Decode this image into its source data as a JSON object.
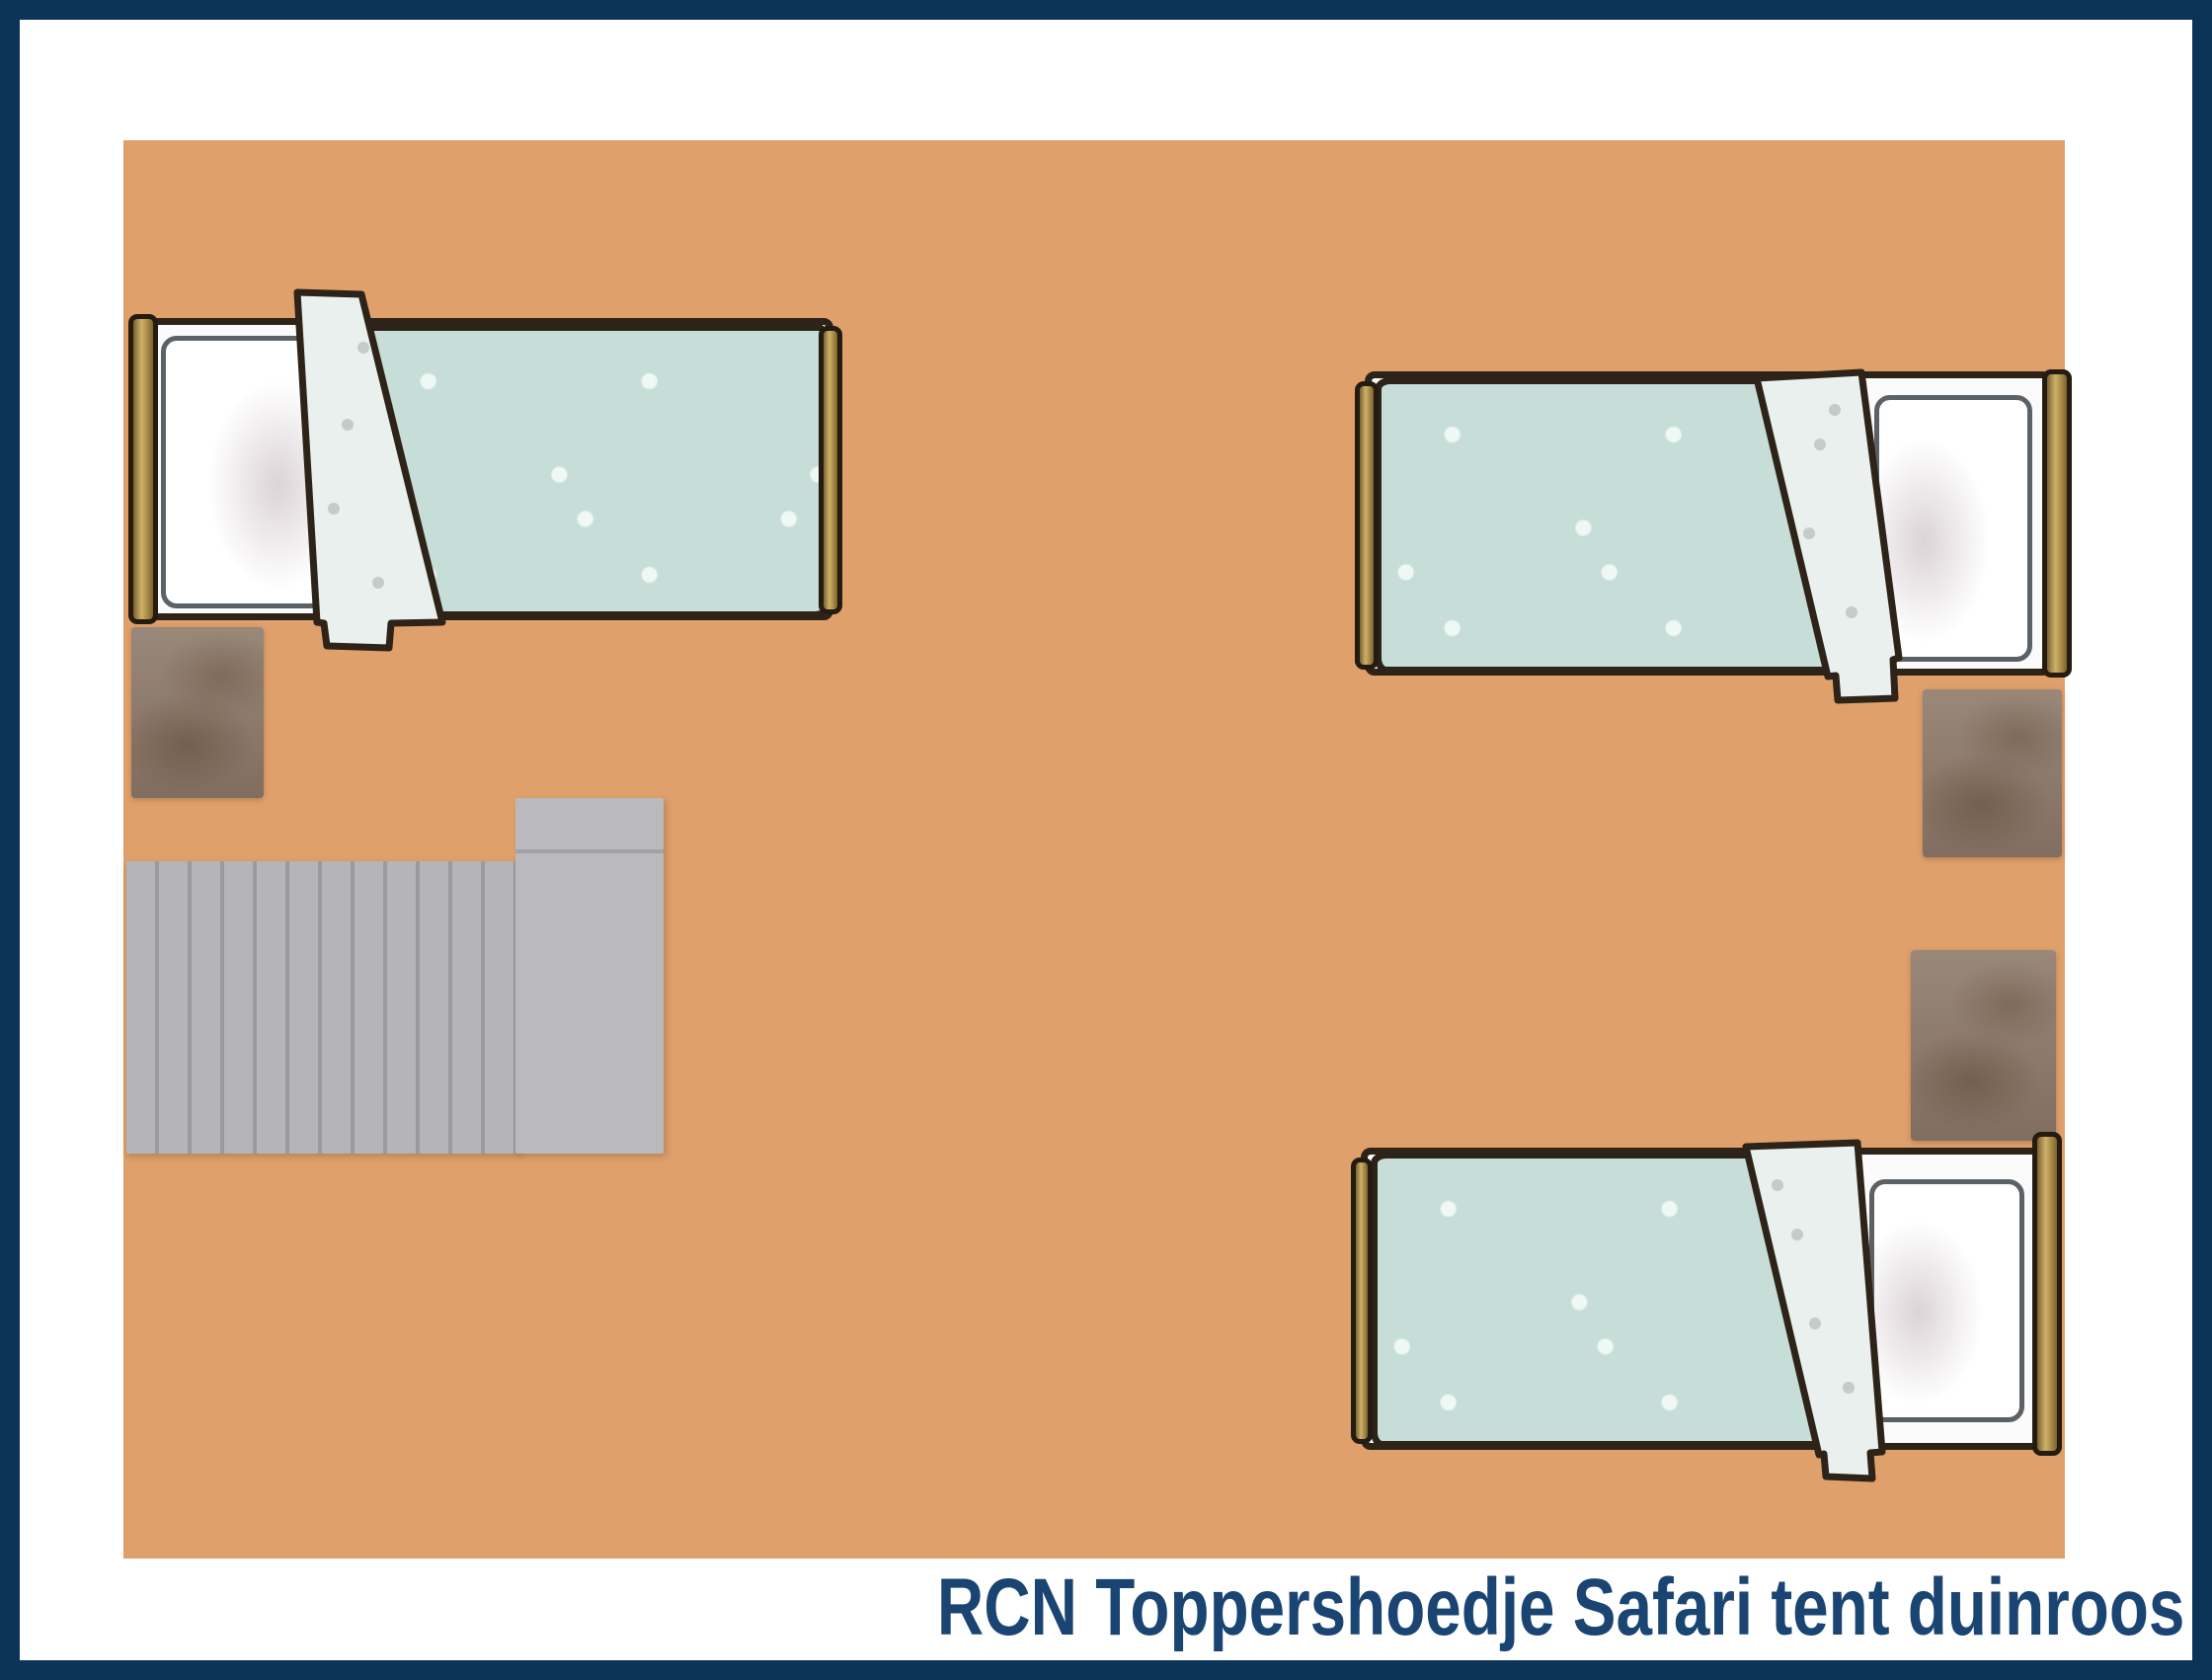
{
  "caption": {
    "text": "RCN Toppershoedje Safari tent duinroos"
  },
  "floorplan": {
    "floor_label": "Floor",
    "stairs_label": "Staircase",
    "stairs_landing_label": "Stair landing",
    "beds": {
      "top_left": "Single bed top left",
      "top_right": "Single bed top right",
      "bottom_right": "Single bed bottom right"
    },
    "bed_parts": {
      "headboard": "Headboard",
      "footboard": "Footboard",
      "pillow": "Pillow",
      "duvet": "Duvet",
      "fold": "Folded duvet edge"
    },
    "rugs": {
      "left": "Rug beside left bed",
      "right_top": "Rug beside top right bed",
      "right_bottom": "Rug beside bottom right bed"
    }
  },
  "colors": {
    "border": "#0c3459",
    "caption_text": "#1a4472",
    "floor": "#e0a06b",
    "duvet": "#c7ded8",
    "sheet_fold": "#e9f0ed",
    "bed_outline": "#2e2318",
    "wood": "#b2934c",
    "rug": "#8e7b6d",
    "stairs": "#b5b4b8"
  }
}
